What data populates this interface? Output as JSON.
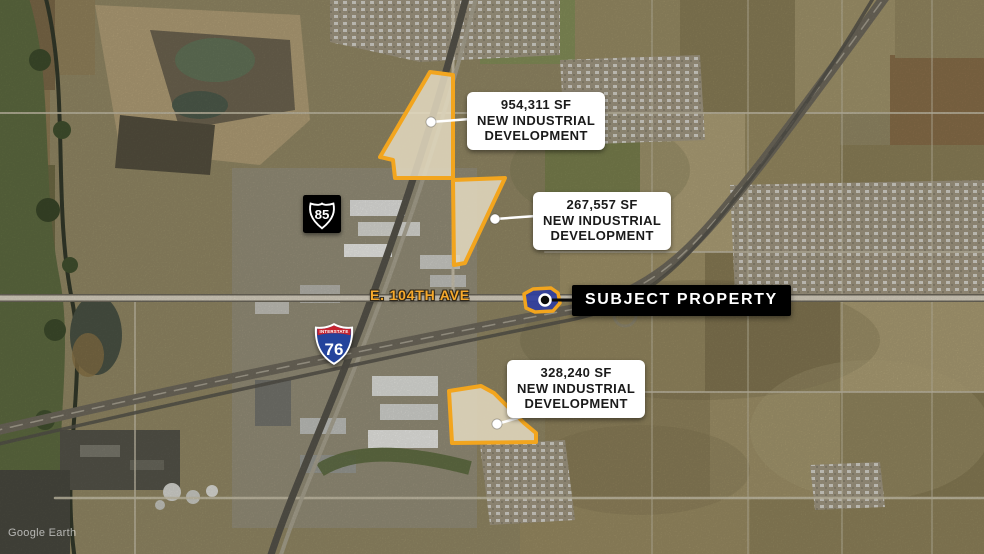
{
  "map": {
    "watermark": "Google Earth",
    "road_label": "E. 104TH AVE",
    "shield_us85": {
      "icon": "us-route-shield",
      "number": "85"
    },
    "shield_i76": {
      "icon": "interstate-shield",
      "banner": "INTERSTATE",
      "number": "76"
    }
  },
  "subject_property": {
    "label": "SUBJECT PROPERTY",
    "marker": "black-dot-white-ring"
  },
  "callouts": [
    {
      "id": "development-a",
      "size_sf": "954,311 SF",
      "line2": "NEW INDUSTRIAL",
      "line3": "DEVELOPMENT"
    },
    {
      "id": "development-b",
      "size_sf": "267,557 SF",
      "line2": "NEW INDUSTRIAL",
      "line3": "DEVELOPMENT"
    },
    {
      "id": "development-c",
      "size_sf": "328,240 SF",
      "line2": "NEW INDUSTRIAL",
      "line3": "DEVELOPMENT"
    }
  ],
  "colors": {
    "parcel_outline": "#F2A51E",
    "parcel_fill": "rgba(228,219,193,0.85)",
    "subject_fill": "#2F3E9E",
    "callout_bg": "#FFFFFF",
    "callout_text": "#1A1A1A",
    "subject_label_bg": "#000000",
    "subject_label_text": "#FFFFFF",
    "road_label_color": "#F6A92C",
    "leader_light": "#FFFFFF",
    "leader_dark": "#0A0A0A"
  }
}
